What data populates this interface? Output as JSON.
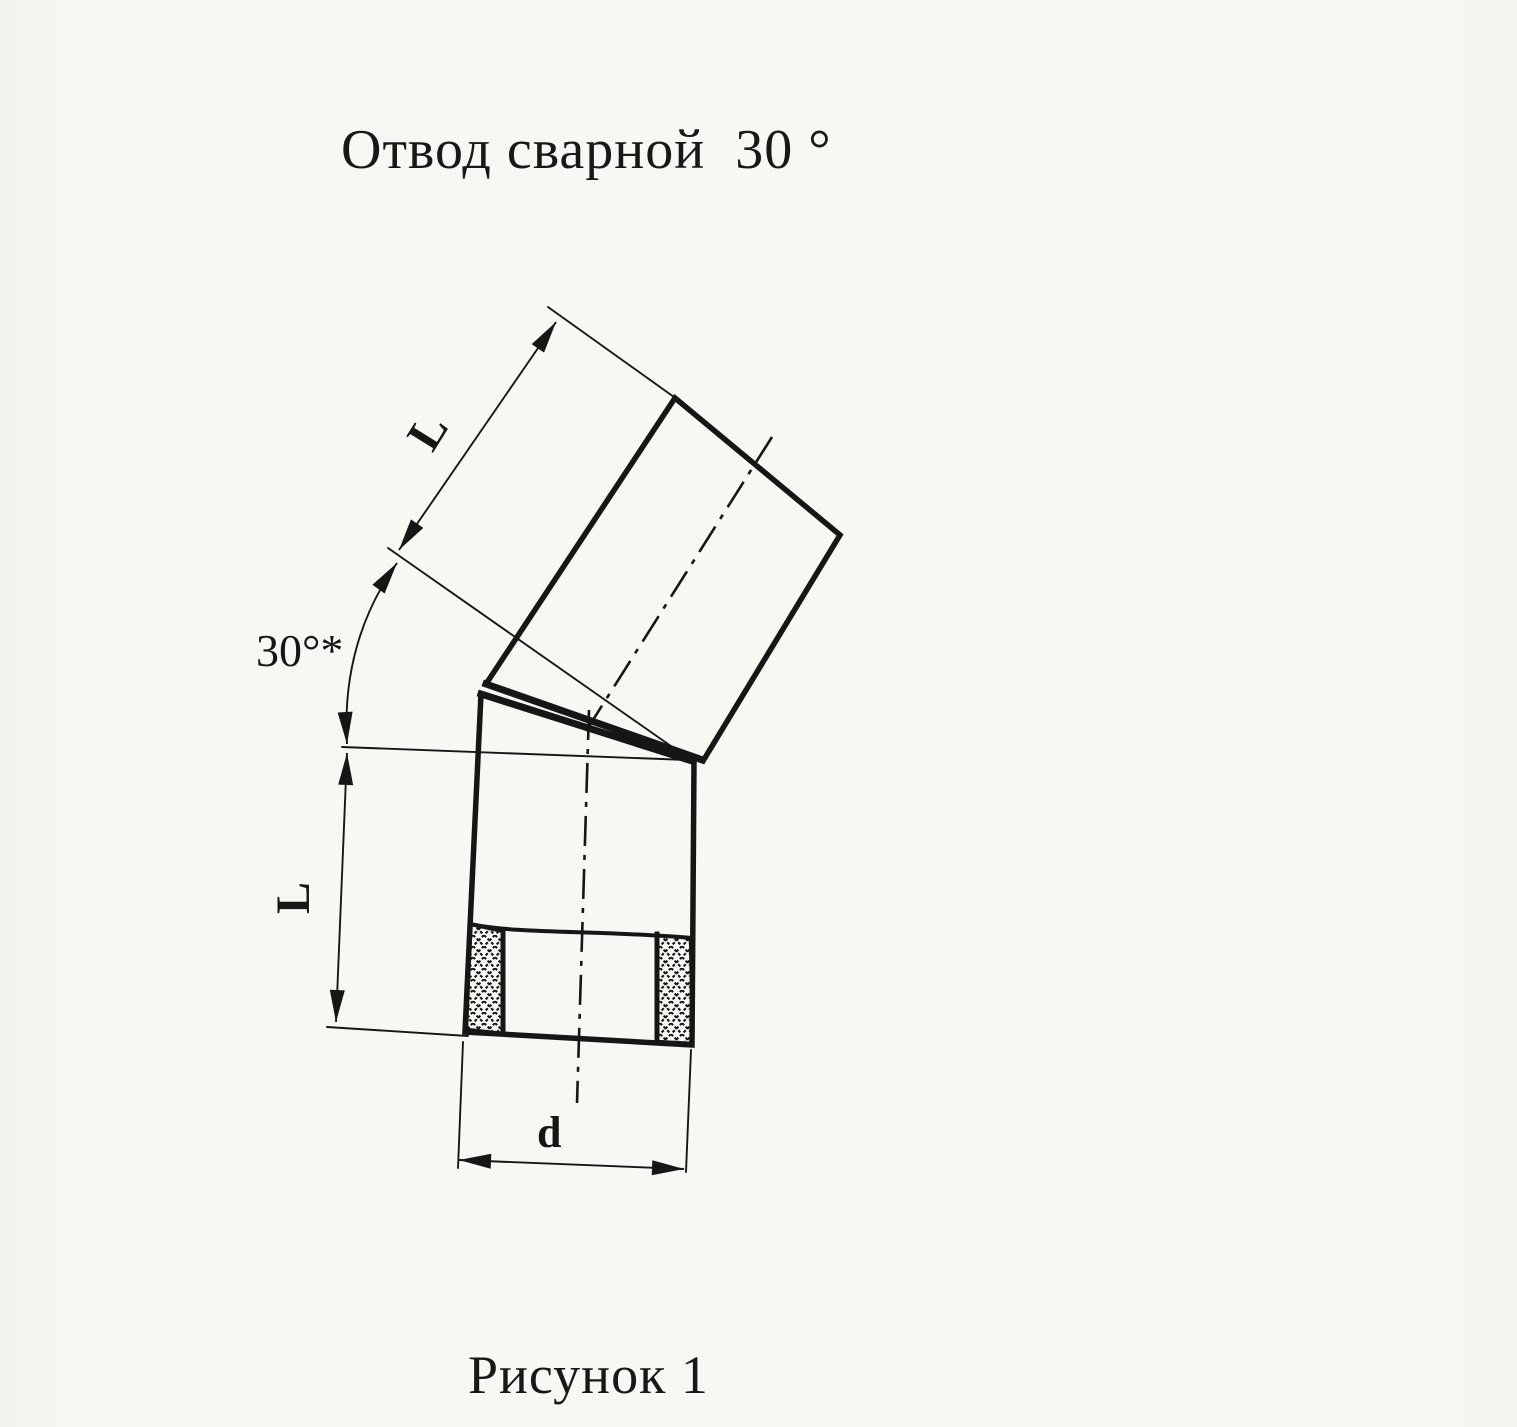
{
  "title": "Отвод сварной  30 °",
  "figure_caption": "Рисунок 1",
  "dimension_labels": {
    "upper_segment_length": "L",
    "lower_segment_length": "L",
    "bend_angle": "30°*",
    "pipe_diameter": "d"
  },
  "drawing": {
    "subject": "welded pipe elbow, two straight segments joined at a 30° weld seam",
    "view": "side elevation with sectioned lower pipe end showing wall cross-hatch",
    "ink_color": "#161616",
    "paper_color": "#f8f7f4"
  }
}
